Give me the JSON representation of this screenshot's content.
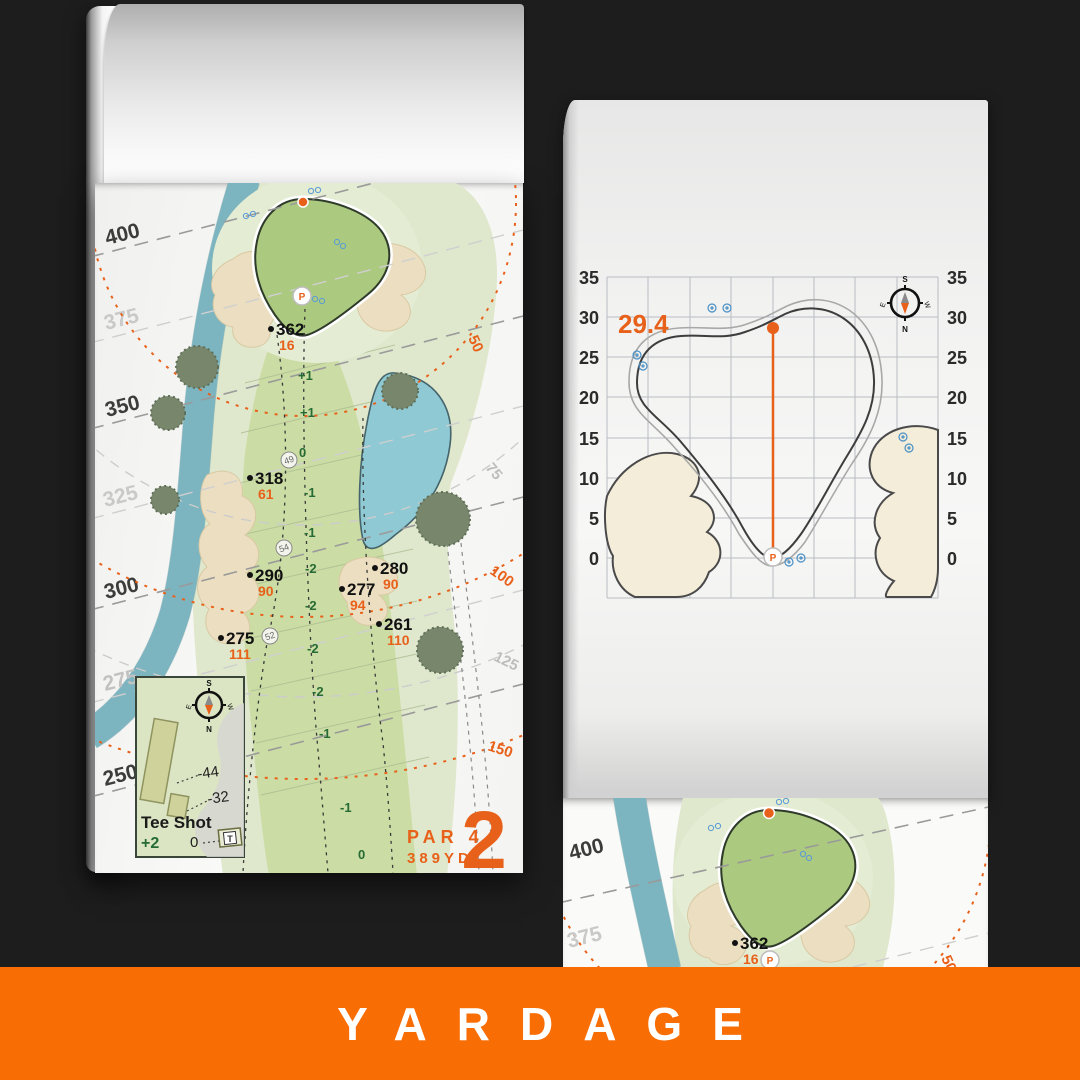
{
  "footer": {
    "title": "YARDAGE"
  },
  "hole": {
    "number": "2",
    "par": "PAR 4",
    "yards": "389YD"
  },
  "compass": {
    "n": "N",
    "s": "S",
    "e": "E",
    "w": "W"
  },
  "left_map": {
    "distance_labels": [
      "400",
      "375",
      "350",
      "325",
      "300",
      "275",
      "250"
    ],
    "range_labels": [
      "50",
      "75",
      "100",
      "125",
      "150"
    ],
    "markers": [
      {
        "yards": "362",
        "pin": "16"
      },
      {
        "yards": "318",
        "pin": "61"
      },
      {
        "yards": "290",
        "pin": "90"
      },
      {
        "yards": "275",
        "pin": "111"
      },
      {
        "yards": "280",
        "pin": "90"
      },
      {
        "yards": "277",
        "pin": "94"
      },
      {
        "yards": "261",
        "pin": "110"
      }
    ],
    "elevations": [
      "+1",
      "+1",
      "0",
      "-1",
      "-1",
      "-2",
      "-2",
      "-2",
      "-2",
      "-1",
      "-1",
      "0"
    ],
    "waypoints": [
      "49",
      "54",
      "52"
    ],
    "pin_letter": "P",
    "inset": {
      "title": "Tee Shot",
      "shots": "+2",
      "back": "-44",
      "mid": "-32",
      "front": "0",
      "tee": "T"
    }
  },
  "green_chart": {
    "depth": "29.4",
    "ticks": [
      "35",
      "30",
      "25",
      "20",
      "15",
      "10",
      "5",
      "0"
    ],
    "pin_letter": "P"
  },
  "chart_data": {
    "type": "outline",
    "y_ticks": [
      35,
      30,
      25,
      20,
      15,
      10,
      5,
      0
    ],
    "y_axis_sides": "both",
    "grid": true,
    "green_depth_yards": 29.4,
    "pin": {
      "depth_from_front": 29.4,
      "front_depth": 0
    }
  },
  "preview_map": {
    "distance_labels": [
      "400",
      "375"
    ],
    "range_label": "50",
    "marker": {
      "yards": "362",
      "pin": "16"
    },
    "pin_letter": "P"
  }
}
